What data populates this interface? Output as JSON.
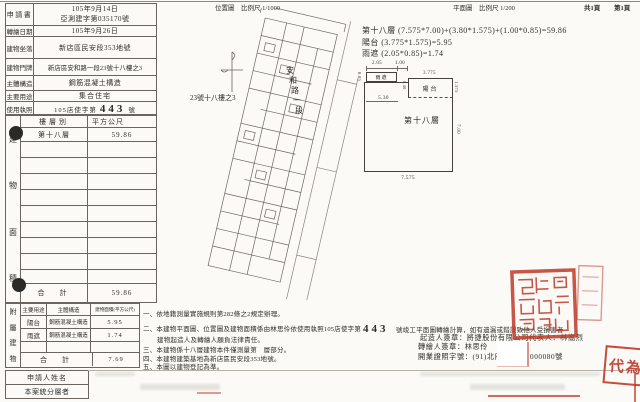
{
  "doc": {
    "headers": {
      "location_map": "位置圖　比例尺 1/1000",
      "floor_plan": "平面圖　比例尺 1/200",
      "pages": "共1頁",
      "page_no": "第1頁"
    },
    "info": {
      "rows": [
        {
          "label": "申請書",
          "value1": "105年9月14日",
          "value2": "亞測建字第035170號"
        },
        {
          "label": "轉繪日期",
          "value": "105年9月26日"
        },
        {
          "label": "建物坐落",
          "value": "新店區民安段353地號"
        },
        {
          "label": "建物門牌",
          "value": "新店區安和路一段23號十八樓之3"
        },
        {
          "label": "主體構造",
          "value": "鋼筋混凝土構造"
        },
        {
          "label": "主要用途",
          "value": "集合住宅"
        },
        {
          "label": "使用執照",
          "prefix": "105店使字第",
          "number": "443",
          "suffix": "號"
        }
      ]
    },
    "floor_table": {
      "chars": [
        "建",
        "物",
        "面",
        "積"
      ],
      "col_floor": "樓層別",
      "col_area": "平方公尺",
      "row_floor": "第十八層",
      "row_area": "59.86",
      "total_label": "合　計",
      "total": "59.86"
    },
    "annex_table": {
      "chars": [
        "附",
        "屬",
        "建",
        "物"
      ],
      "col_use": "主要用途",
      "col_structure": "主體構造",
      "col_area": "建物面積(平方公尺)",
      "rows": [
        {
          "use": "陽台",
          "structure": "鋼筋混凝土構造",
          "area": "5.95"
        },
        {
          "use": "雨遮",
          "structure": "鋼筋混凝土構造",
          "area": "1.74"
        }
      ],
      "total_label": "合　計",
      "total": "7.69"
    },
    "bottom": {
      "applicant": "申請人姓名",
      "staff": "本案統分層者"
    },
    "site_map": {
      "building_label": "23號十八樓之3",
      "road_chars": [
        "安",
        "和",
        "路",
        "一",
        "段"
      ]
    },
    "plan": {
      "formula1": "第十八層 (7.575*7.00)+(3.80*1.575)+(1.00*0.85)=59.86",
      "formula2": "陽台 (3.775*1.575)=5.95",
      "formula3": "雨遮 (2.05*0.85)=1.74",
      "labels": {
        "main": "第十八層",
        "balcony": "陽台",
        "canopy": "雨遮"
      },
      "dims": {
        "d205": "2.05",
        "d100": "1.00",
        "d085": "0.85",
        "d3775": "3.775",
        "d1575": "1.575",
        "d040": "0.40",
        "d530": "5.30",
        "d700": "7.00",
        "d7575": "7.575"
      }
    },
    "notes": {
      "n1": "一、依地籍測量實施規則第282條之2規定辦理。",
      "n2": "二、本建物平面圖、位置圖及建物面積係由林思伶依使用執照105店使字第",
      "n2_number": "443",
      "n2_cont": "號竣工平面圖轉繪計算，如有遺漏或錯誤致他人受損害者",
      "n3": "建物起造人及轉繪人願負法律責任。",
      "n4": "三、本建物係十八層建物本件僅測量第　層部分。",
      "n5": "四、本建物建築基地為新店區民安段353地號。",
      "n6": "五、本圖以建物登記為準。"
    },
    "signatures": {
      "builder": "起造人簽章：將捷股份有限公司代表人：林嵩烈",
      "transcriber": "轉繪人簽章：林思伶",
      "license_prefix": "開業證照字號：(91)北府",
      "license_suffix": "000080號"
    },
    "stamps": {
      "proxy": "代為"
    }
  }
}
